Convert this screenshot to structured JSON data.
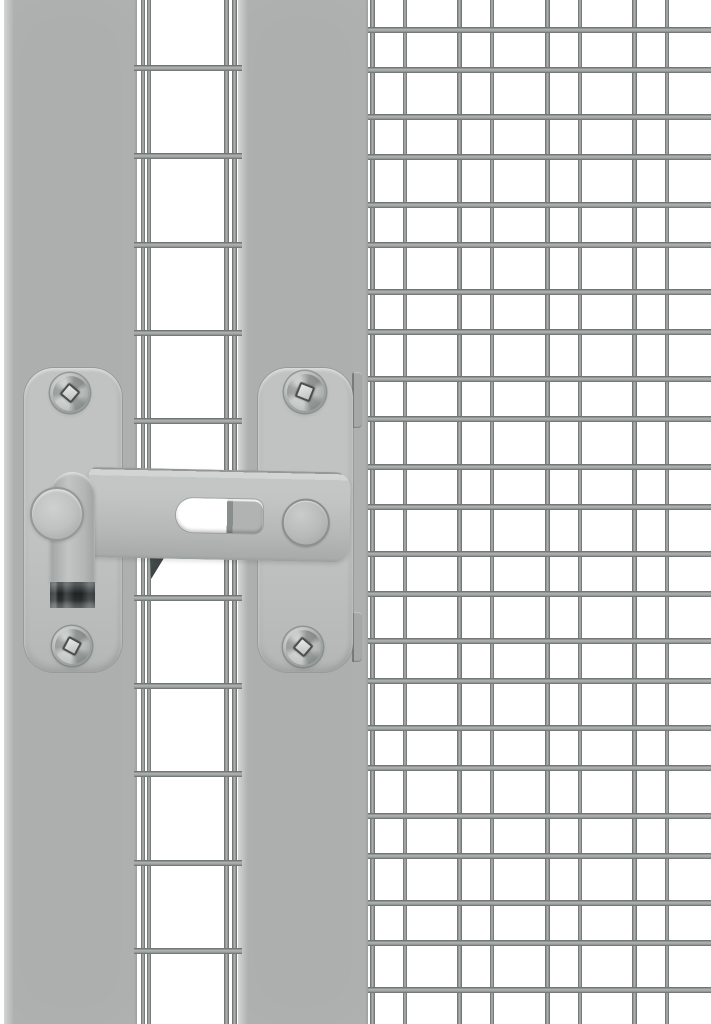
{
  "image": {
    "kind": "product-photo",
    "subject": "Silver-grey steel gate latch with pull handle, mounted between a wire-mesh door panel and a wire-mesh side panel of an aviary / animal enclosure",
    "width_px": 711,
    "height_px": 1024,
    "background_color": "#ffffff"
  },
  "palette": {
    "white": "#ffffff",
    "bar_body": "#acafae",
    "bar_edge_light": "#d2d5d4",
    "bar_edge_dark": "#9a9d9c",
    "plate": "#c0c3c2",
    "plate_dark": "#b4b7b6",
    "wire_core": "#b3b7b6",
    "wire_edge": "#636766",
    "slot_gray": "#b0b3b2",
    "slot_wire": "#898d8c",
    "tip_dark": "#262b2c",
    "wedge_dark": "#3b4042",
    "screw_hi": "#dadedd",
    "screw_lo": "#878d8c",
    "drive_fill": "#e8eae9",
    "drive_edge": "#4a4f4e"
  },
  "scene": {
    "frame_bars": [
      {
        "name": "frame-bar-left",
        "x": 4,
        "y": 0,
        "w": 133,
        "h": 1024
      },
      {
        "name": "frame-bar-right",
        "x": 238,
        "y": 0,
        "w": 130,
        "h": 1024
      }
    ],
    "left_mesh": {
      "region": {
        "x": 134,
        "y": 0,
        "w": 108,
        "h": 1024
      },
      "vertical_wires": [
        {
          "x": 140.5,
          "w": 4
        },
        {
          "x": 147,
          "w": 4
        },
        {
          "x": 224,
          "w": 4.5
        },
        {
          "x": 231.5,
          "w": 5
        }
      ],
      "horizontal_wires": {
        "first_y": 65,
        "period": 88.3,
        "count": 12,
        "thickness": 6
      }
    },
    "right_mesh": {
      "region": {
        "x": 368,
        "y": 0,
        "w": 343,
        "h": 1024
      },
      "vertical_wires": {
        "origin_x": 370,
        "period": 87.3,
        "offsets": [
          0,
          33
        ],
        "widths": [
          5,
          4
        ],
        "pairs": 4
      },
      "horizontal_wires": {
        "offsets": [
          27,
          67
        ],
        "period": 87.3,
        "rows": 12,
        "thickness": 6
      }
    },
    "plates": [
      {
        "name": "mounting-plate-left",
        "x": 24,
        "y": 368,
        "w": 98,
        "h": 304,
        "radius": 30
      },
      {
        "name": "mounting-plate-right",
        "x": 258,
        "y": 368,
        "w": 95,
        "h": 304,
        "radius": 30
      }
    ],
    "screws": [
      {
        "cx": 70,
        "cy": 393,
        "r": 20,
        "drive_angle": 40
      },
      {
        "cx": 72,
        "cy": 646,
        "r": 20,
        "drive_angle": 28
      },
      {
        "cx": 305,
        "cy": 392,
        "r": 21,
        "drive_angle": 22
      },
      {
        "cx": 303,
        "cy": 647,
        "r": 20,
        "drive_angle": 40
      }
    ],
    "plate_tabs": [
      {
        "x": 352,
        "y": 372,
        "w": 10,
        "h": 56
      },
      {
        "x": 352,
        "y": 612,
        "w": 10,
        "h": 50
      }
    ],
    "latch": {
      "bar": {
        "x": 88,
        "y": 467,
        "w": 262,
        "h": 90,
        "rotate_deg": 1.2
      },
      "slot": {
        "local_x": 88,
        "local_y": 29,
        "w": 87,
        "h": 34,
        "wire_stripe_x": 51,
        "wire_stripe_w": 6
      },
      "knob": {
        "local_cx": 216,
        "local_cy": 49,
        "r": 22
      },
      "handle": {
        "x": 50,
        "y": 472,
        "w": 45,
        "h": 112
      },
      "handle_tip": {
        "x": 50,
        "y": 582,
        "w": 45,
        "h": 26
      },
      "pivot": {
        "cx": 55,
        "cy": 512,
        "r": 25
      },
      "catch_shadow": {
        "x": 150,
        "y": 558,
        "w": 14,
        "h": 21
      }
    }
  }
}
